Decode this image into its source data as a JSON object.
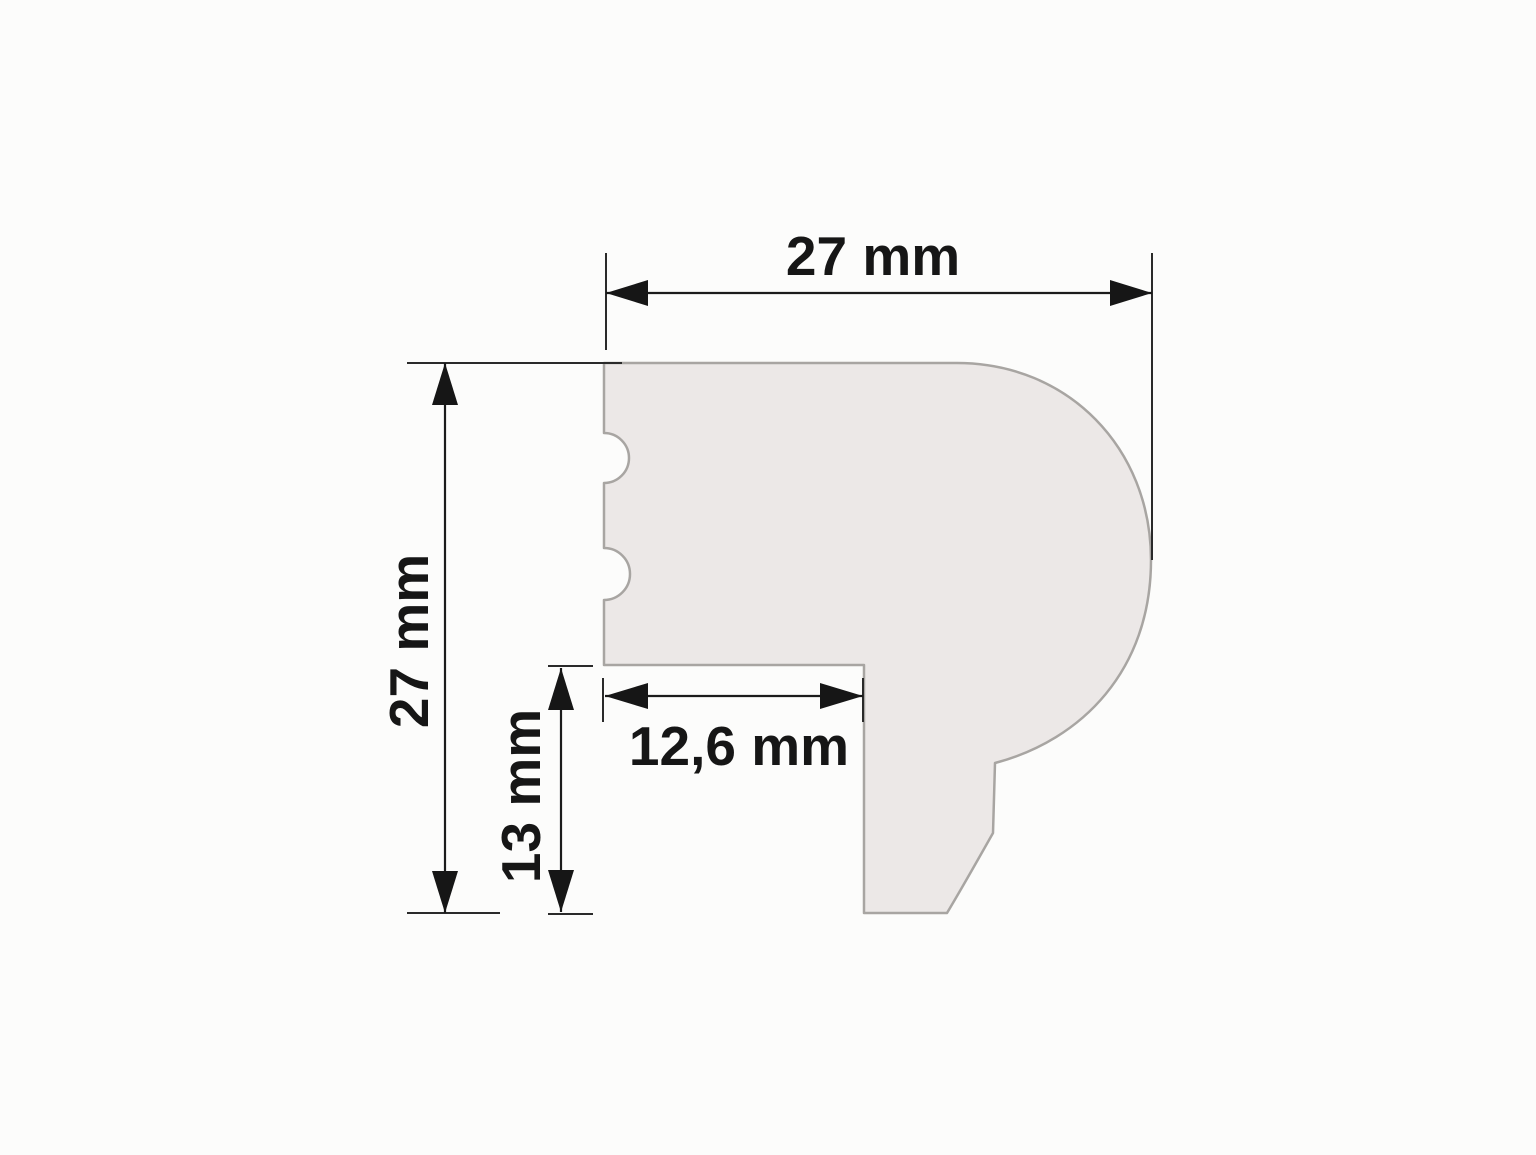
{
  "diagram": {
    "unit": "mm",
    "labels": {
      "top_width": "27 mm",
      "left_height": "27 mm",
      "leg_height": "13 mm",
      "step_width": "12,6 mm"
    },
    "values": {
      "top_width_mm": 27,
      "left_height_mm": 27,
      "leg_height_mm": 13,
      "step_width_mm": 12.6
    },
    "colors": {
      "background": "#fcfcfb",
      "profile_fill": "#ece8e7",
      "profile_outline": "#a8a5a2",
      "dimension_line": "#1b1b1b"
    }
  }
}
